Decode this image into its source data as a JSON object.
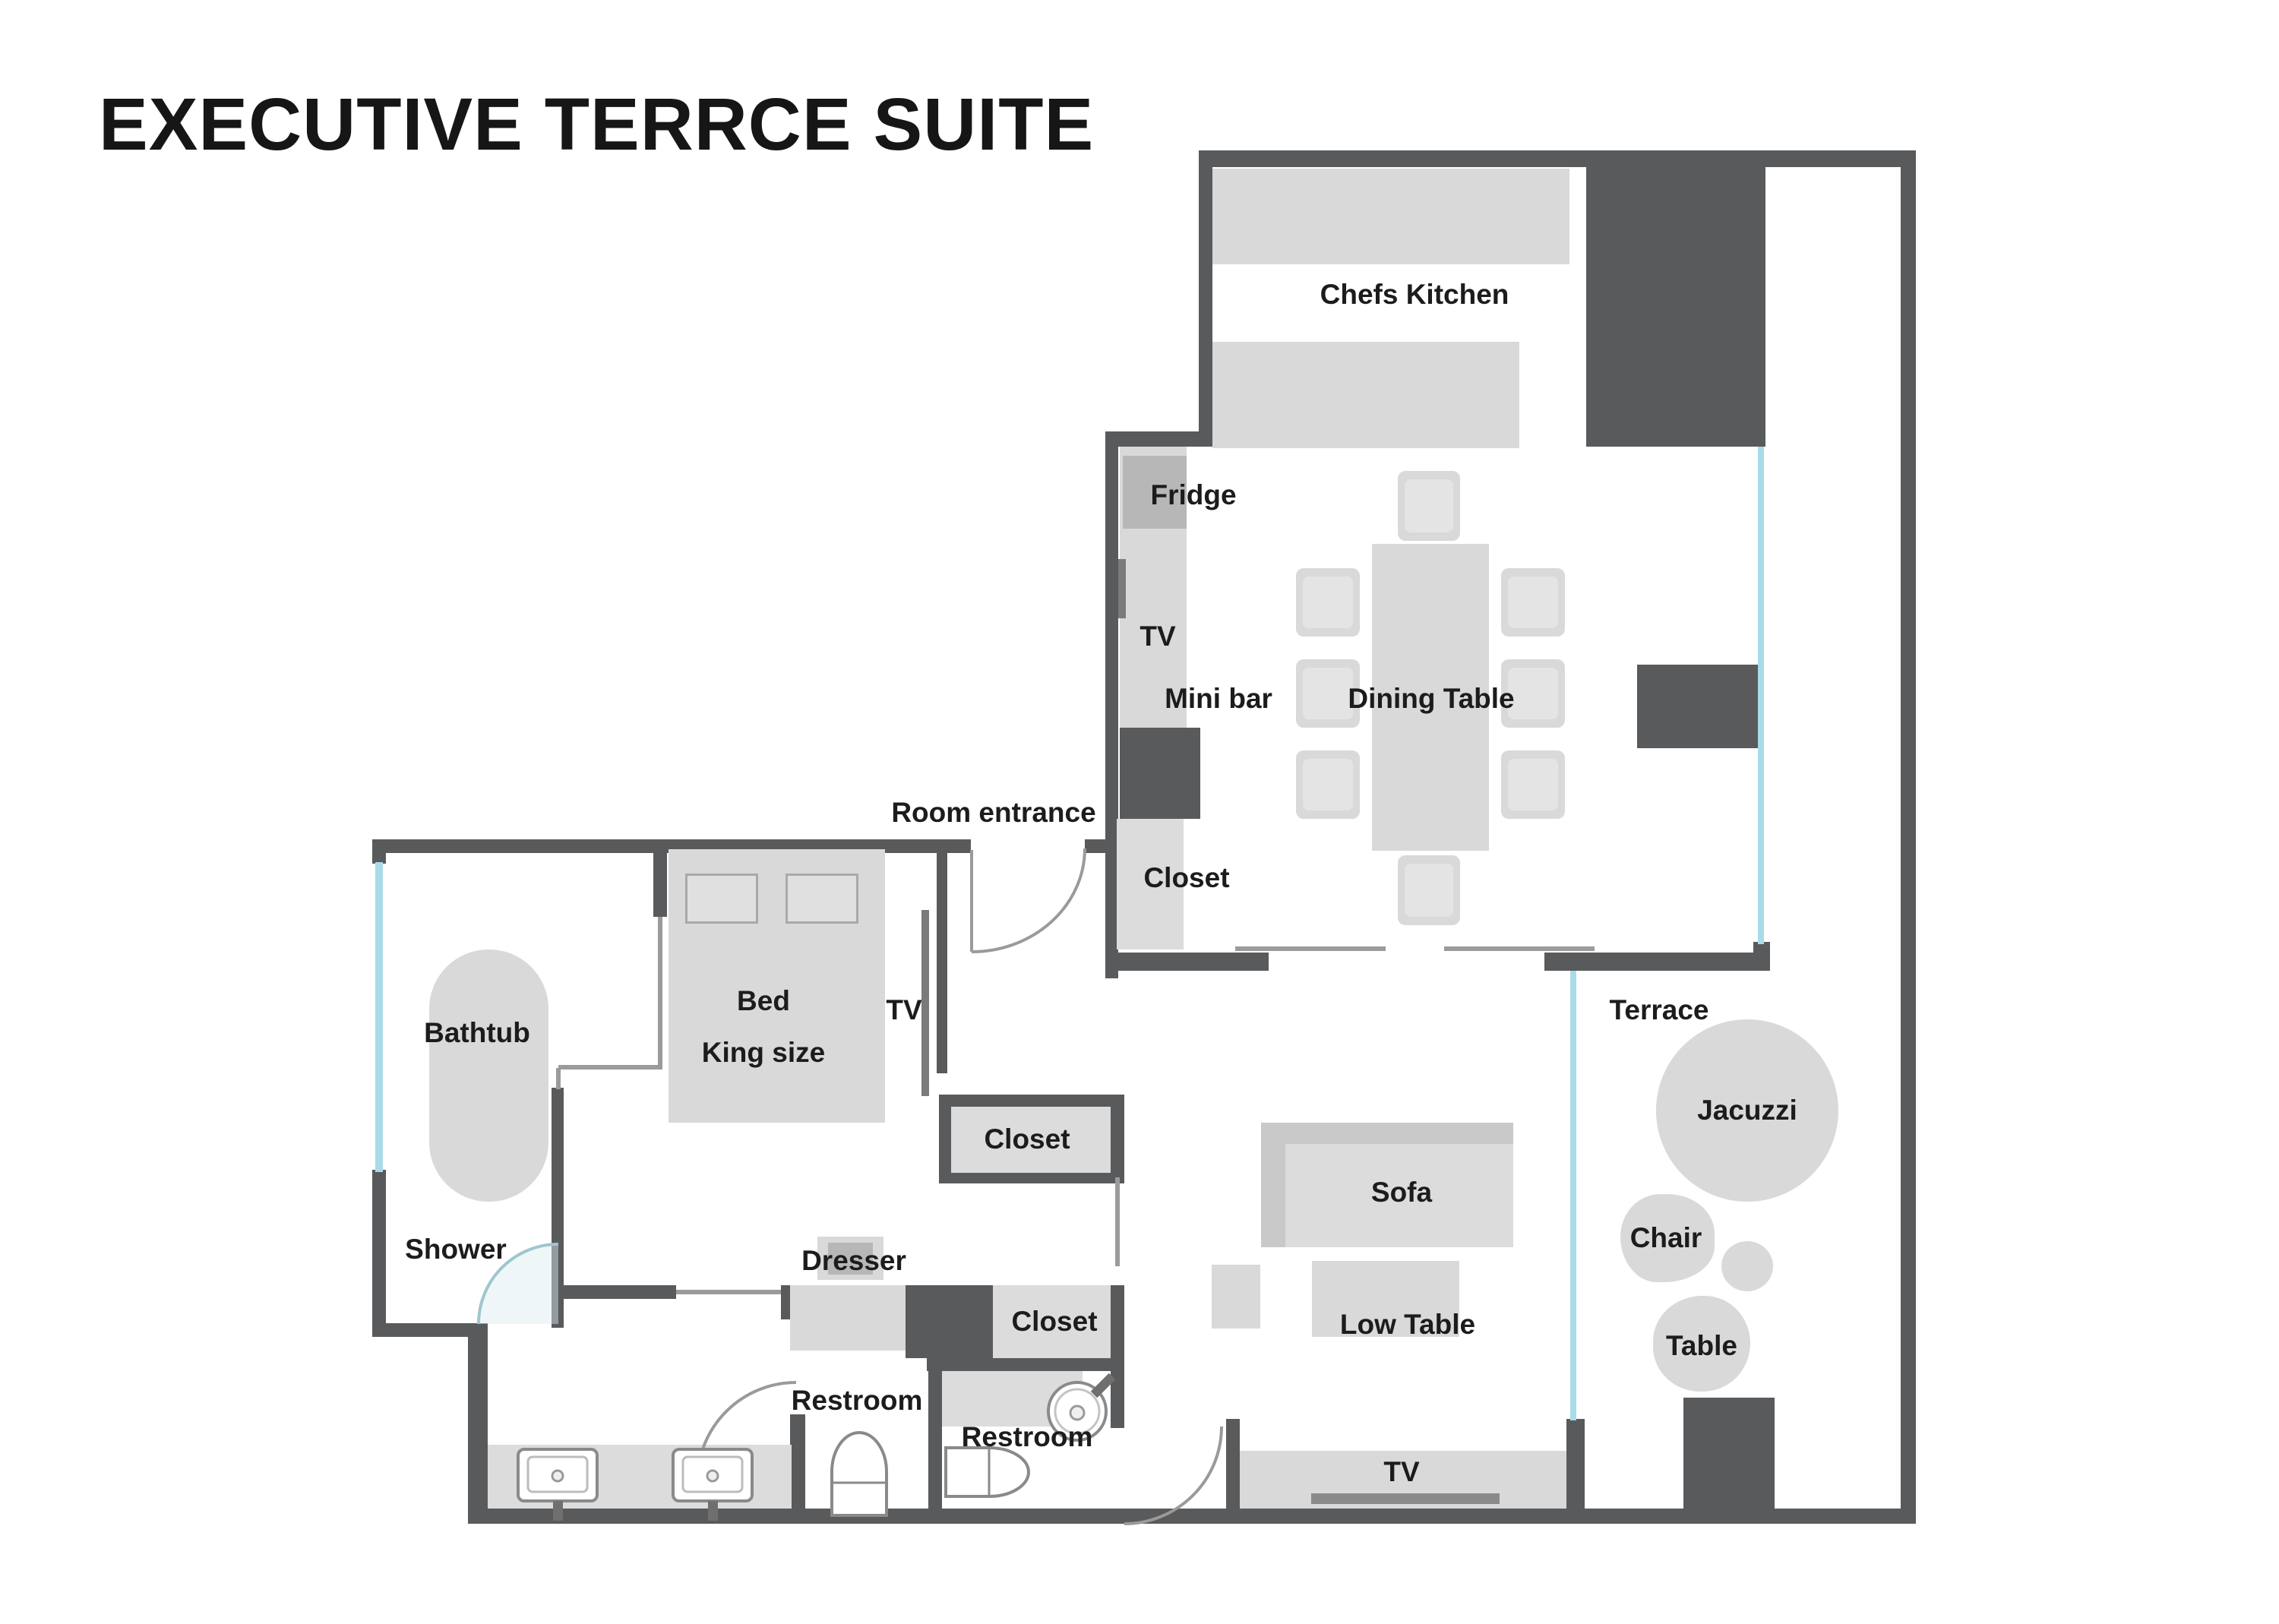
{
  "title": "EXECUTIVE TERRCE SUITE",
  "floorplan": {
    "kitchen": {
      "label": "Chefs Kitchen",
      "fridge": "Fridge",
      "tv": "TV",
      "mini_bar": "Mini bar",
      "dining_table": "Dining Table",
      "closet": "Closet"
    },
    "entrance": {
      "label": "Room entrance"
    },
    "bedroom": {
      "bed": "Bed",
      "bed_size": "King size",
      "tv": "TV",
      "closet": "Closet",
      "dresser": "Dresser"
    },
    "bathroom": {
      "bathtub": "Bathtub",
      "shower": "Shower"
    },
    "hallway": {
      "closet": "Closet"
    },
    "restrooms": {
      "left": "Restroom",
      "right": "Restroom"
    },
    "living_room": {
      "sofa": "Sofa",
      "low_table": "Low Table",
      "tv": "TV"
    },
    "terrace": {
      "label": "Terrace",
      "jacuzzi": "Jacuzzi",
      "chair": "Chair",
      "table": "Table"
    }
  },
  "colors": {
    "wall": "#595a5c",
    "furniture": "#d9d9d9",
    "appliance": "#b7b7b7",
    "window_glass": "#a9dbe8",
    "screen": "#7a7a7a",
    "thin_line": "#9b9b9b",
    "text": "#1c1c1c",
    "background": "#ffffff"
  }
}
